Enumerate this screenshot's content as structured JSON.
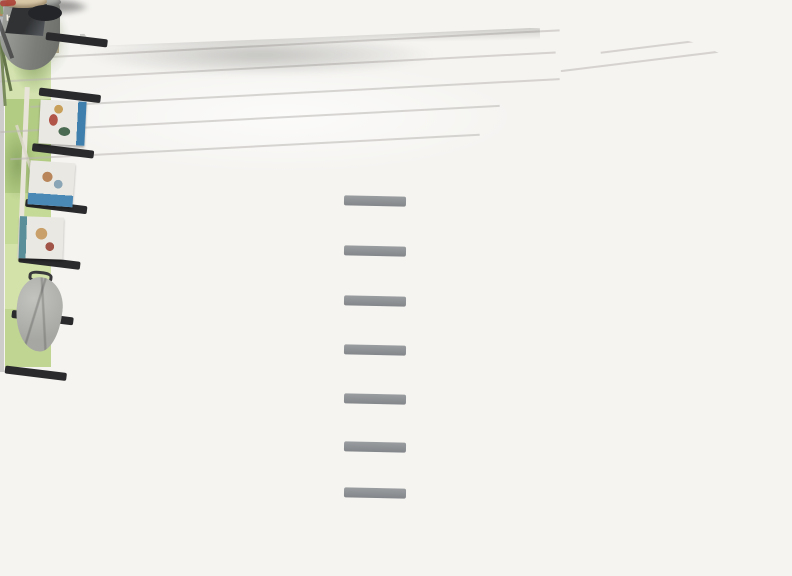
{
  "meta": {
    "type": "photograph",
    "description": "Bright room with a grey high-sleeper loft bed over a desk, charcoal futon sofa bed with yellow blanket, black leaning magazine ladder, orange pouf and mustard rug"
  },
  "text": {
    "decorative_box_label": "hava"
  },
  "palette": {
    "wall_grey": "#a8a6a4",
    "bed_grey": "#8f9295",
    "bedding_gold": "#d8b571",
    "futon_charcoal": "#3a3b3d",
    "blanket_yellow": "#ddbc2d",
    "rug_mustard": "#d1b062",
    "pouf_orange": "#dd8a3f",
    "ladder_black": "#262628",
    "window_frame_black": "#1f1f1d",
    "floor_white": "#efeeeb",
    "accent_red_box": "#b2423a"
  },
  "scene": {
    "wall_art_count": 3,
    "wall_art_style": "vintage collage portraits",
    "furniture": [
      "grey loft bed with ladder",
      "desk with white laptop",
      "black wobble stool",
      "charcoal futon sofa bed",
      "black leaning ladder with magazines and hoodie",
      "orange pouf",
      "potted plant in grey pot",
      "twin ceiling spotlight",
      "shelf with books and pencil case"
    ]
  }
}
